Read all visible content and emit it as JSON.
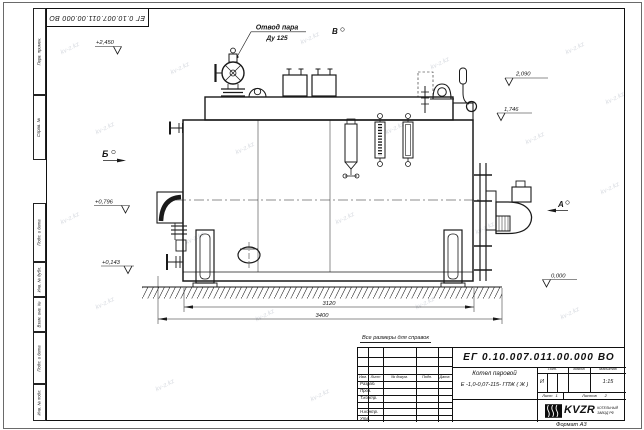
{
  "meta": {
    "format_label": "Формат А3",
    "note": "Все размеры для справок",
    "watermark": "kv-z.kz"
  },
  "frame": {
    "stamp_top": "ЕГ 0.10.007.011.00.000  ВО",
    "side_labels": [
      "Перв. примен.",
      "Справ. №",
      "Подп. и дата",
      "Инв. № дубл.",
      "Взам. инв. №",
      "Подп. и дата",
      "Инв. № подл."
    ]
  },
  "drawing": {
    "callout_line1": "Отвод пара",
    "callout_line2": "Ду 125",
    "views": {
      "b": "Б",
      "v": "В",
      "a": "А"
    },
    "elevations": {
      "e2450": "+2,450",
      "e2090": "2,090",
      "e1746": "1,746",
      "e0796": "+0,796",
      "e0143": "+0,143",
      "e0000": "0,000"
    },
    "dimensions": {
      "inner": "3120",
      "overall": "3400"
    }
  },
  "title_block": {
    "doc_number": "ЕГ 0.10.007.011.00.000  ВО",
    "product_line1": "Котел паровой",
    "product_line2": "Е -1,0-0,07-115- ГПЖ ( Ж )",
    "col_izm": "Изм.",
    "col_list": "Лист",
    "col_doc": "№ докум.",
    "col_podp": "Подп.",
    "col_data": "Дата",
    "rows": [
      "Разраб.",
      "Пров.",
      "Т.контр.",
      "Н.контр.",
      "Утв."
    ],
    "lit_header": "Лит.",
    "massa_header": "Масса",
    "masshtab_header": "Масштаб",
    "lit_value": "И",
    "scale": "1:15",
    "sheet_label": "Лист",
    "sheet_value": "1",
    "sheets_label": "Листов",
    "sheets_value": "2",
    "logo_text": "KVZR",
    "logo_cap1": "КОТЕЛЬНЫЙ",
    "logo_cap2": "ЗАВОД РФ"
  }
}
